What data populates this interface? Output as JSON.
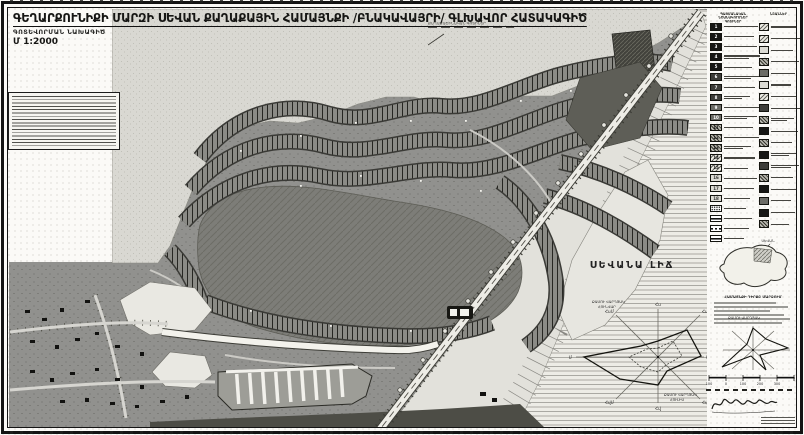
{
  "title": {
    "main": "ԳԵՂԱՐՔՈՒՆԻՔԻ ՄԱՐԶԻ ՍԵՎԱՆ ՔԱՂԱՔԱՅԻՆ ՀԱՄԱՅՆՔԻ /ԲՆԱԿԱՎԱՅՐԻ/ ԳԼԽԱՎՈՐ ՀԱՏԱԿԱԳԻԾ",
    "sub": "ԳՈՏԵՎՈՐՄԱՆ ՆԱԽԱԳԻԾ",
    "scale": "Մ 1:2000"
  },
  "callout": {
    "label": "ՔԱՂԱՔԱՇԻՆԱԿԱՆ ԳՈՏԻՆԵՐ"
  },
  "map": {
    "lake_label": "ՍԵՎԱՆԱ ԼԻՃ"
  },
  "legend": {
    "left_heading": [
      "ՊԱՅՄԱՆԱԿԱՆ ՆՇԱՆԱԿՈՒՄՆԵՐ",
      "ԳՈՏԻՆԵՐ"
    ],
    "right_heading": "ՆՇԱՆՆԵՐ",
    "left": [
      {
        "n": "1",
        "s": "k",
        "l": 1,
        "w": 34
      },
      {
        "n": "2",
        "s": "k",
        "l": 1,
        "w": 30
      },
      {
        "n": "3",
        "s": "k",
        "l": 1,
        "w": 33
      },
      {
        "n": "4",
        "s": "k",
        "l": 2,
        "w": 36
      },
      {
        "n": "5",
        "s": "k",
        "l": 1,
        "w": 28
      },
      {
        "n": "6",
        "s": "d",
        "l": 2,
        "w": 38
      },
      {
        "n": "7",
        "s": "d",
        "l": 1,
        "w": 31
      },
      {
        "n": "8",
        "s": "d",
        "l": 2,
        "w": 26
      },
      {
        "n": "9",
        "s": "m",
        "l": 1,
        "w": 37
      },
      {
        "n": "10",
        "s": "m",
        "l": 2,
        "w": 33
      },
      {
        "n": "11",
        "s": "h",
        "l": 1,
        "w": 29
      },
      {
        "n": "12",
        "s": "h",
        "l": 1,
        "w": 35
      },
      {
        "n": "13",
        "s": "h",
        "l": 2,
        "w": 27
      },
      {
        "n": "14",
        "s": "lh",
        "l": 1,
        "w": 31
      },
      {
        "n": "15",
        "s": "lh",
        "l": 1,
        "w": 24
      },
      {
        "n": "16",
        "s": "lt",
        "l": 1,
        "w": 33
      },
      {
        "n": "17",
        "s": "lt",
        "l": 1,
        "w": 30
      },
      {
        "n": "18",
        "s": "lt",
        "l": 1,
        "w": 26
      },
      {
        "n": "",
        "s": "dd",
        "l": 1,
        "w": 22
      },
      {
        "n": "",
        "s": "ln",
        "l": 1,
        "w": 28
      },
      {
        "n": "",
        "s": "dl",
        "l": 1,
        "w": 25
      },
      {
        "n": "",
        "s": "ln",
        "l": 1,
        "w": 20
      }
    ],
    "right": [
      {
        "n": "",
        "s": "lh",
        "l": 1,
        "w": 26
      },
      {
        "n": "",
        "s": "lh",
        "l": 1,
        "w": 30
      },
      {
        "n": "",
        "s": "lt",
        "l": 1,
        "w": 22
      },
      {
        "n": "",
        "s": "h",
        "l": 1,
        "w": 28
      },
      {
        "n": "",
        "s": "m",
        "l": 1,
        "w": 24
      },
      {
        "n": "",
        "s": "lt",
        "l": 1,
        "w": 20
      },
      {
        "n": "",
        "s": "lh",
        "l": 1,
        "w": 26
      },
      {
        "n": "",
        "s": "d",
        "l": 1,
        "w": 30
      },
      {
        "n": "",
        "s": "h",
        "l": 2,
        "w": 23
      },
      {
        "n": "",
        "s": "k",
        "l": 1,
        "w": 27
      },
      {
        "n": "",
        "s": "h",
        "l": 1,
        "w": 21
      },
      {
        "n": "",
        "s": "k",
        "l": 2,
        "w": 25
      },
      {
        "n": "",
        "s": "d",
        "l": 2,
        "w": 28
      },
      {
        "n": "",
        "s": "h",
        "l": 1,
        "w": 22
      },
      {
        "n": "",
        "s": "k",
        "l": 1,
        "w": 26
      },
      {
        "n": "",
        "s": "m",
        "l": 1,
        "w": 20
      },
      {
        "n": "",
        "s": "k",
        "l": 1,
        "w": 24
      },
      {
        "n": "",
        "s": "h",
        "l": 1,
        "w": 18
      }
    ]
  },
  "rose_axes": {
    "n": "Հս",
    "ne": "ՀսԱ",
    "e": "Ա",
    "se": "ՀվԱ",
    "s": "Հվ",
    "sw_": "ՀվՄ",
    "w": "Մ",
    "nw": "ՀսՄ"
  },
  "rose_large": {
    "cap_top_1": "ՔԱՄՈՒ ՎԱՐԴՅԱԿ",
    "cap_top_2": "ՀՈՒՆՎԱՐ",
    "cap_br_1": "ՔԱՄՈՒ ՎԱՐԴՅԱԿ",
    "cap_br_2": "ՀՈՒԼԻՍ",
    "points": "658,341 687,330 701,356 667,371 658,385 620,379 584,357 641,346",
    "points_inner": "658,348 673,341 682,356 666,365 658,372 641,367 629,357 647,349"
  },
  "rose_small": {
    "caption": "ՔԱՄՈՒ ՎԱՐԴՅԱԿ",
    "points": "47,18 60,29 82,38 54,45 60,60 45,46 16,57 41,34"
  },
  "inset": {
    "heading": "ՀԱՄԱՅՆՔԻ ԴԻՐՔԸ ՄԱՐԶՈՒՄ",
    "marker": "ՍԵՎԱՆ"
  },
  "scale_bar": {
    "numbers": [
      "100",
      "0",
      "100",
      "200",
      "300"
    ]
  },
  "colors": {
    "ink": "#141414",
    "developed_gray": "#91918e",
    "open_land_gray": "#d9d8d2",
    "lake_line_gray": "#a3a29c",
    "band_dark": "#3a3a38"
  }
}
